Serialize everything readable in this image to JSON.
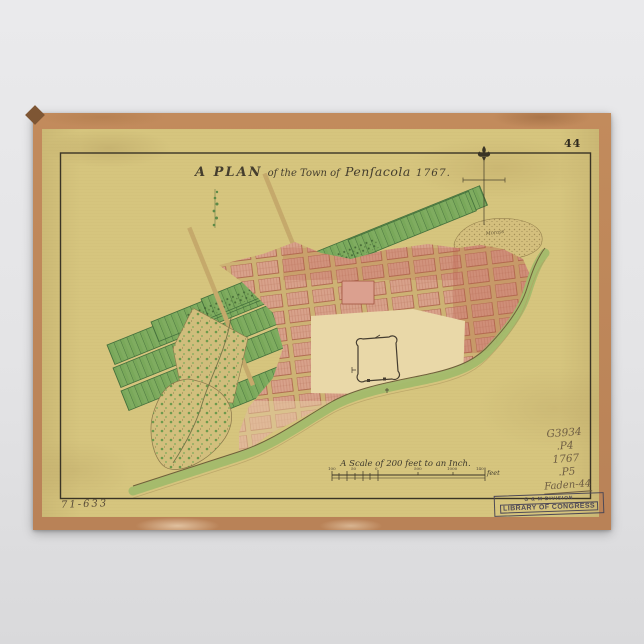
{
  "background_color": "#e6e6e8",
  "poster": {
    "paper_color": "#d6c57e",
    "edge_color": "#c28b5c",
    "plate_number": "44",
    "title": {
      "prefix": "A PLAN",
      "middle": "of the Town of",
      "place": "Penſacola",
      "year": "1767."
    },
    "map": {
      "hill_label": "Morass",
      "colors": {
        "field_green": "#7fac60",
        "field_green_dark": "#44703c",
        "town_pink": "#d8a28b",
        "town_red": "#b95f4c",
        "plaza_cream": "#e9d8a8",
        "shore_green": "#a2bb6b",
        "ink": "#3a3425"
      }
    },
    "scale_bar": {
      "caption": "A Scale of 200 feet to an Inch.",
      "unit_label": "feet",
      "tick_labels": [
        "100",
        "50",
        "0",
        "500",
        "1000",
        "1400"
      ]
    },
    "annotations": {
      "margin_note": "71-633",
      "call_number_lines": [
        "G3934",
        ".P4",
        "1767",
        ".P5",
        "Faden-44"
      ],
      "stamp_line1": "G & M DIVISION",
      "stamp_line2": "LIBRARY OF CONGRESS"
    }
  }
}
